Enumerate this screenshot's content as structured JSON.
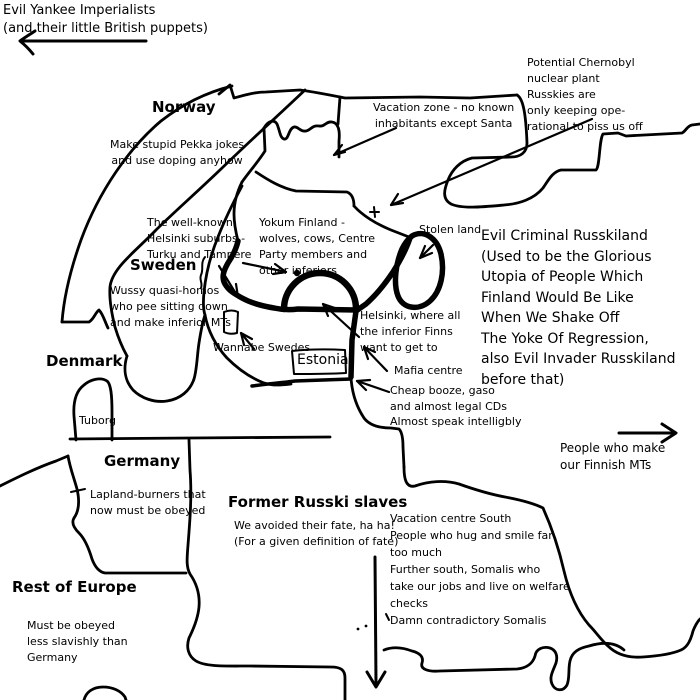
{
  "image": {
    "kind": "satirical hand-drawn map of Finland and neighbours",
    "background_color": "#ffffff",
    "ink_color": "#000000"
  },
  "labels": {
    "yankee_imperialists": "Evil Yankee Imperialists\n(and their little British puppets)",
    "norway": "Norway",
    "pekka_jokes": "Make stupid Pekka jokes\nand use doping anyhow",
    "vacation_zone": "Vacation zone - no known\ninhabitants except Santa",
    "chernobyl": "Potential Chernobyl\nnuclear plant\nRusskies are\nonly keeping ope-\nrational to piss us off",
    "helsinki_suburbs": "The well-known\nHelsinki suburbs -\nTurku and Tampere",
    "yokum_finland": "Yokum Finland -\nwolves, cows, Centre\nParty members and\nother inferiors",
    "sweden": "Sweden",
    "wussy_swedes": "Wussy quasi-homos\nwho pee sitting down\nand make inferior MTs",
    "stolen_land": "Stolen land",
    "russkiland": "Evil Criminal Russkiland\n(Used to be the Glorious\nUtopia of People Which\nFinland Would Be Like\nWhen We Shake Off\nThe Yoke Of Regression,\nalso Evil Invader Russkiland\nbefore that)",
    "wannabe_swedes": "Wannabe Swedes",
    "helsinki": "Helsinki, where all\nthe inferior Finns\nwant to get to",
    "estonia": "Estonia",
    "mafia_centre": "Mafia centre",
    "cheap_booze": "Cheap booze, gaso\nand almost legal CDs\nAlmost speak intelligbly",
    "denmark": "Denmark",
    "tuborg": "Tuborg",
    "germany": "Germany",
    "lapland_burners": "Lapland-burners that\nnow must be obeyed",
    "former_slaves": "Former Russki slaves",
    "avoided_fate": "We avoided their fate, ha ha!\n(For a given definition of fate)",
    "vacation_south": "Vacation centre South\nPeople who hug and smile far\ntoo much\nFurther south, Somalis who\ntake our jobs and live on welfare\nchecks\nDamn contradictory Somalis",
    "finnish_mts": "People who make\nour Finnish MTs",
    "rest_of_europe": "Rest of Europe",
    "must_be_obeyed": "Must be obeyed\nless slavishly than\nGermany"
  }
}
